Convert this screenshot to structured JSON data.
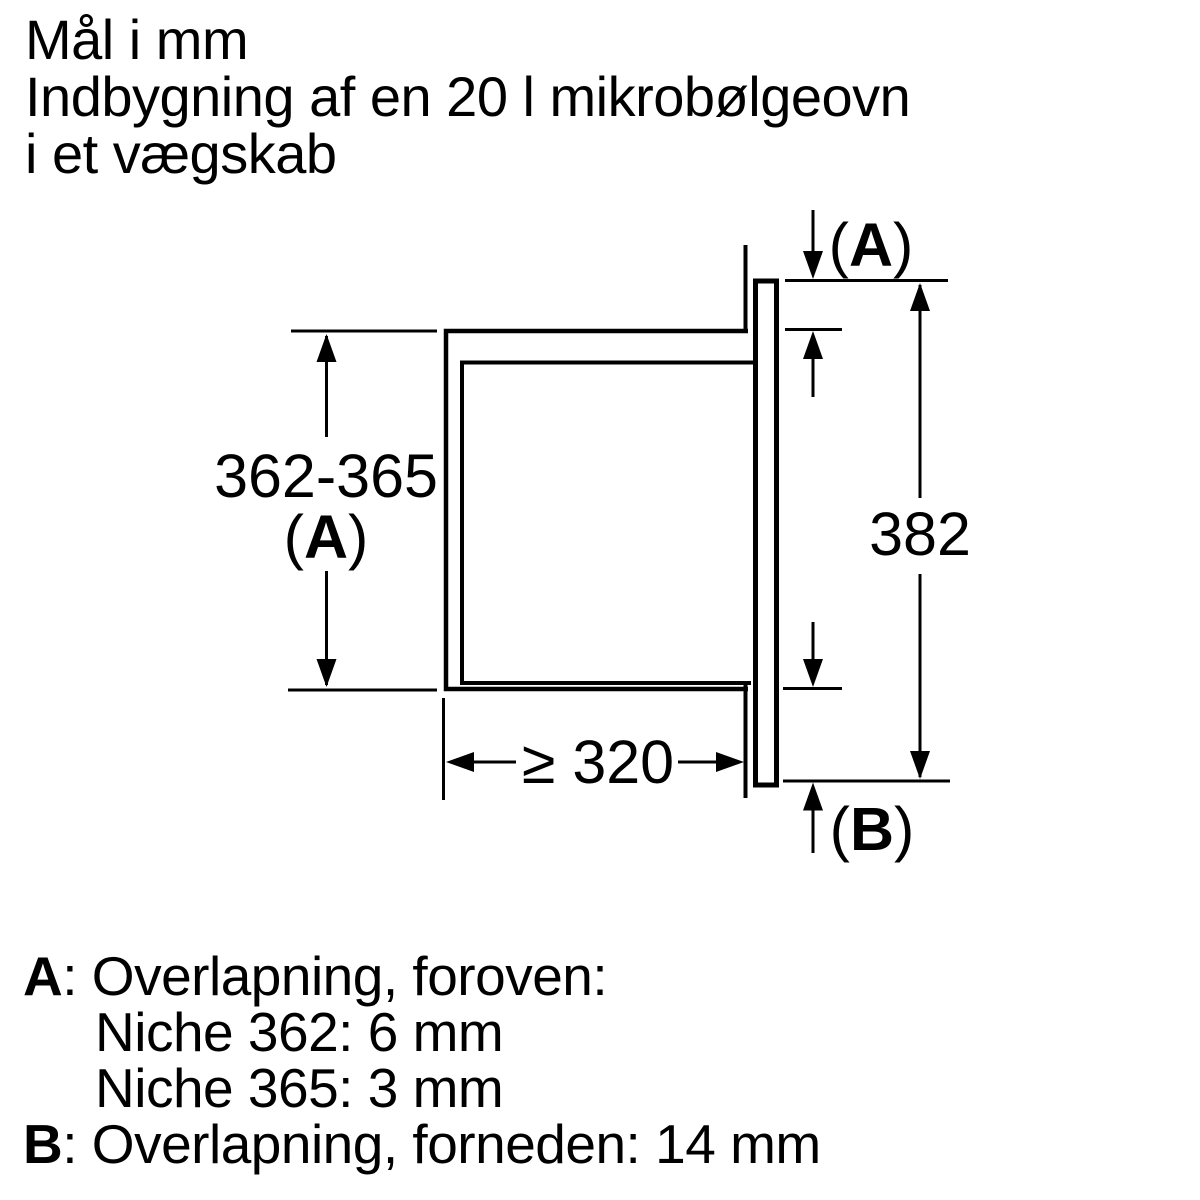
{
  "title": {
    "lines": [
      "Mål i mm",
      "Indbygning af en 20 l mikrobølgeovn",
      "i et vægskab"
    ]
  },
  "diagram": {
    "dim_niche_height": {
      "value": "362-365",
      "label_open": "(",
      "label_letter": "A",
      "label_close": ")"
    },
    "dim_frame_height": {
      "value": "382"
    },
    "dim_depth_min": {
      "value": "≥ 320"
    },
    "overlap_top": {
      "open": "(",
      "letter": "A",
      "close": ")"
    },
    "overlap_bottom": {
      "open": "(",
      "letter": "B",
      "close": ")"
    }
  },
  "legend": {
    "a": {
      "key": "A",
      "rest": ": Overlapning, foroven:"
    },
    "a_niche_362": "Niche 362: 6 mm",
    "a_niche_365": "Niche 365: 3 mm",
    "b": {
      "key": "B",
      "rest": ": Overlapning, forneden: 14 mm"
    }
  },
  "colors": {
    "ink": "#000000",
    "background": "#ffffff"
  }
}
